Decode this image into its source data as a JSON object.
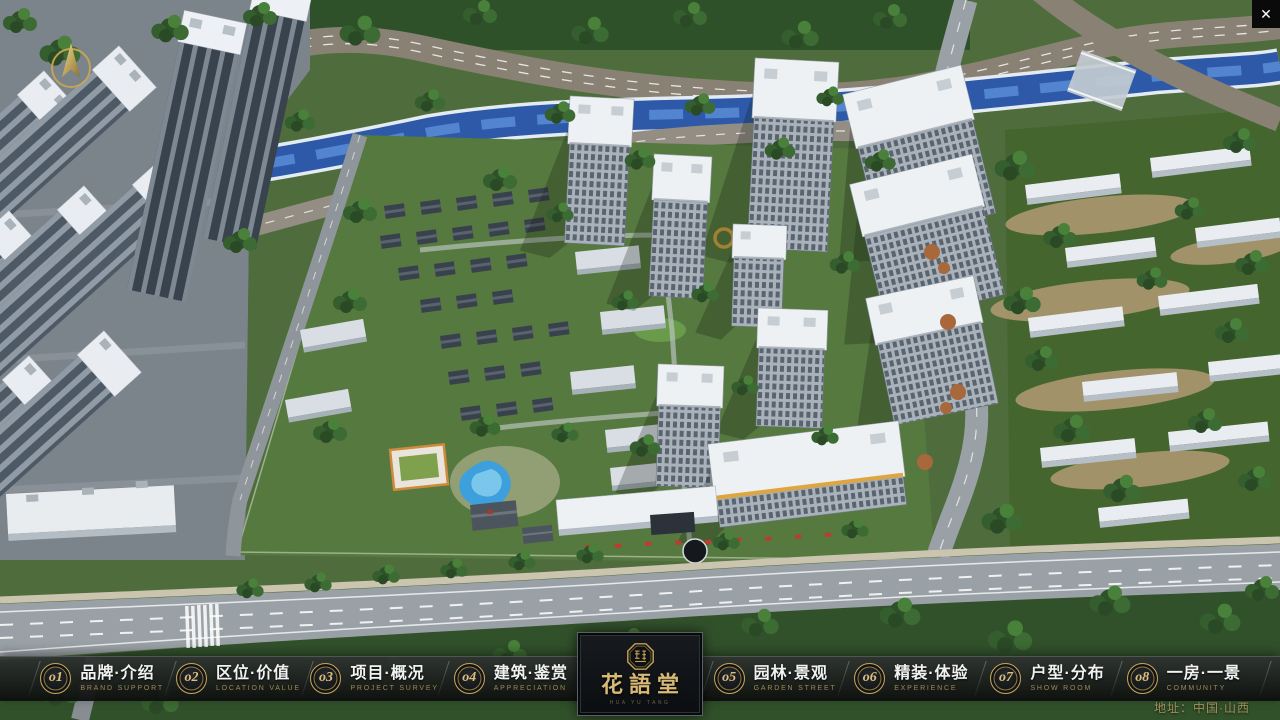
{
  "window": {
    "close_icon": "✕"
  },
  "navbar": {
    "items": [
      {
        "num": "o1",
        "zh": "品牌·介绍",
        "en": "BRAND SUPPORT"
      },
      {
        "num": "o2",
        "zh": "区位·价值",
        "en": "LOCATION VALUE"
      },
      {
        "num": "o3",
        "zh": "项目·概况",
        "en": "PROJECT SURVEY"
      },
      {
        "num": "o4",
        "zh": "建筑·鉴赏",
        "en": "APPRECIATION"
      },
      {
        "num": "o5",
        "zh": "园林·景观",
        "en": "GARDEN STREET"
      },
      {
        "num": "o6",
        "zh": "精装·体验",
        "en": "EXPERIENCE"
      },
      {
        "num": "o7",
        "zh": "户型·分布",
        "en": "SHOW ROOM"
      },
      {
        "num": "o8",
        "zh": "一房·一景",
        "en": "COMMUNITY"
      }
    ]
  },
  "logo": {
    "title": "花語堂",
    "subtitle": "HUA YU TANG"
  },
  "footer": {
    "address": "地址：中国·山西"
  },
  "colors": {
    "gold": "#c7a65c",
    "nav_bg": "#15181a",
    "river": "#2d59a8",
    "grass": "#55793f"
  }
}
